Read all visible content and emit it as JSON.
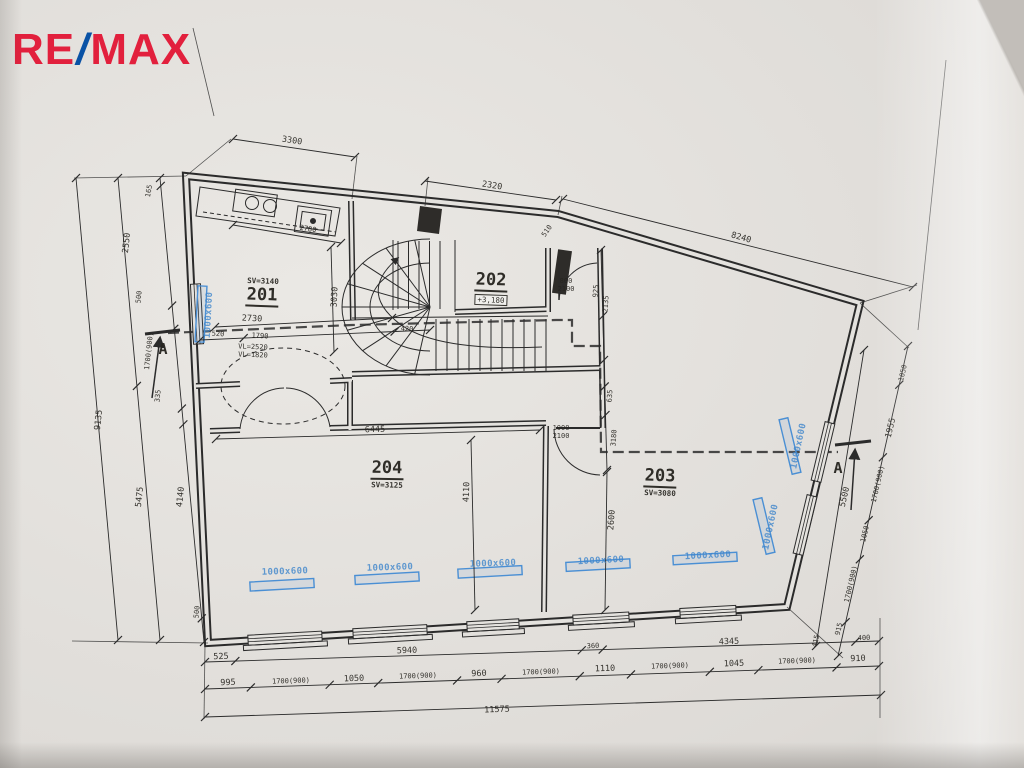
{
  "logo": {
    "re": "RE",
    "slash": "/",
    "max": "MAX"
  },
  "colors": {
    "logo_red": "#e2203d",
    "logo_blue": "#0a52a5",
    "ink": "#2b2b2b",
    "radiator_blue": "#4a8fd4",
    "paper": "#e4e2de"
  },
  "rooms": [
    {
      "number": "201",
      "ceiling": "SV=3140"
    },
    {
      "number": "202",
      "elevation": "+3,180"
    },
    {
      "number": "203",
      "ceiling": "SV=3080"
    },
    {
      "number": "204",
      "ceiling": "SV=3125"
    }
  ],
  "labels": [
    {
      "t": "3300",
      "x": 292,
      "y": 141,
      "r": 8
    },
    {
      "t": "2320",
      "x": 492,
      "y": 186,
      "r": 9
    },
    {
      "t": "8240",
      "x": 741,
      "y": 238,
      "r": 16
    },
    {
      "t": "165",
      "x": 149,
      "y": 191,
      "r": -80,
      "c": "t"
    },
    {
      "t": "2550",
      "x": 127,
      "y": 243,
      "r": -84
    },
    {
      "t": "500",
      "x": 139,
      "y": 297,
      "r": -84,
      "c": "t"
    },
    {
      "t": "1700(900)",
      "x": 149,
      "y": 351,
      "r": -84,
      "c": "t"
    },
    {
      "t": "335",
      "x": 158,
      "y": 396,
      "r": -84,
      "c": "t"
    },
    {
      "t": "4140",
      "x": 181,
      "y": 497,
      "r": -84
    },
    {
      "t": "5475",
      "x": 140,
      "y": 497,
      "r": -84
    },
    {
      "t": "9135",
      "x": 99,
      "y": 420,
      "r": -84
    },
    {
      "t": "500",
      "x": 197,
      "y": 612,
      "r": -84,
      "c": "t"
    },
    {
      "t": "1050",
      "x": 903,
      "y": 373,
      "r": -77,
      "c": "t"
    },
    {
      "t": "1955",
      "x": 891,
      "y": 428,
      "r": -77
    },
    {
      "t": "1700(900)",
      "x": 878,
      "y": 484,
      "r": -77,
      "c": "t"
    },
    {
      "t": "1050",
      "x": 865,
      "y": 534,
      "r": -77,
      "c": "t"
    },
    {
      "t": "1700(900)",
      "x": 851,
      "y": 584,
      "r": -77,
      "c": "t"
    },
    {
      "t": "915",
      "x": 839,
      "y": 629,
      "r": -77,
      "c": "t"
    },
    {
      "t": "415",
      "x": 816,
      "y": 641,
      "r": -77,
      "c": "t"
    },
    {
      "t": "5500",
      "x": 845,
      "y": 497,
      "r": -77
    },
    {
      "t": "525",
      "x": 221,
      "y": 657,
      "r": -2
    },
    {
      "t": "5940",
      "x": 407,
      "y": 651,
      "r": -2
    },
    {
      "t": "360",
      "x": 593,
      "y": 646,
      "r": -2,
      "c": "t"
    },
    {
      "t": "4345",
      "x": 729,
      "y": 642,
      "r": -2
    },
    {
      "t": "400",
      "x": 864,
      "y": 638,
      "r": -2,
      "c": "t"
    },
    {
      "t": "995",
      "x": 228,
      "y": 683,
      "r": -2
    },
    {
      "t": "1700(900)",
      "x": 291,
      "y": 681,
      "r": -2,
      "c": "t"
    },
    {
      "t": "1050",
      "x": 354,
      "y": 679,
      "r": -2
    },
    {
      "t": "1700(900)",
      "x": 418,
      "y": 676,
      "r": -2,
      "c": "t"
    },
    {
      "t": "960",
      "x": 479,
      "y": 674,
      "r": -2
    },
    {
      "t": "1700(900)",
      "x": 541,
      "y": 672,
      "r": -2,
      "c": "t"
    },
    {
      "t": "1110",
      "x": 605,
      "y": 669,
      "r": -2
    },
    {
      "t": "1700(900)",
      "x": 670,
      "y": 666,
      "r": -2,
      "c": "t"
    },
    {
      "t": "1045",
      "x": 734,
      "y": 664,
      "r": -2
    },
    {
      "t": "1700(900)",
      "x": 797,
      "y": 661,
      "r": -2,
      "c": "t"
    },
    {
      "t": "910",
      "x": 858,
      "y": 659,
      "r": -2
    },
    {
      "t": "11575",
      "x": 497,
      "y": 710,
      "r": -2
    },
    {
      "t": "SV=3140",
      "x": 263,
      "y": 281,
      "r": 2,
      "c": "sv"
    },
    {
      "t": "201",
      "x": 262,
      "y": 296,
      "r": 2,
      "c": "room",
      "n": "room-201-number"
    },
    {
      "t": "202",
      "x": 491,
      "y": 281,
      "r": 2,
      "c": "room",
      "n": "room-202-number"
    },
    {
      "t": "+3,180",
      "x": 491,
      "y": 300,
      "r": 2,
      "c": "elev",
      "n": "room-202-elevation"
    },
    {
      "t": "203",
      "x": 660,
      "y": 477,
      "r": 2,
      "c": "room",
      "n": "room-203-number"
    },
    {
      "t": "SV=3080",
      "x": 660,
      "y": 493,
      "r": 2,
      "c": "sv"
    },
    {
      "t": "204",
      "x": 387,
      "y": 469,
      "r": 1,
      "c": "room",
      "n": "room-204-number"
    },
    {
      "t": "SV=3125",
      "x": 387,
      "y": 485,
      "r": 1,
      "c": "sv"
    },
    {
      "t": "2730",
      "x": 252,
      "y": 319,
      "r": 3
    },
    {
      "t": "520",
      "x": 218,
      "y": 334,
      "r": 3,
      "c": "t"
    },
    {
      "t": "1790",
      "x": 260,
      "y": 336,
      "r": 3,
      "c": "t"
    },
    {
      "t": "420",
      "x": 407,
      "y": 329,
      "r": 3,
      "c": "t"
    },
    {
      "t": "VL=2520",
      "x": 253,
      "y": 347,
      "r": 2,
      "c": "t"
    },
    {
      "t": "VL=1820",
      "x": 253,
      "y": 355,
      "r": 2,
      "c": "t"
    },
    {
      "t": "2780",
      "x": 308,
      "y": 229,
      "r": 9,
      "c": "t"
    },
    {
      "t": "6445",
      "x": 375,
      "y": 430,
      "r": -2
    },
    {
      "t": "4110",
      "x": 467,
      "y": 492,
      "r": -88
    },
    {
      "t": "2600",
      "x": 612,
      "y": 520,
      "r": -86
    },
    {
      "t": "3180",
      "x": 614,
      "y": 438,
      "r": -86,
      "c": "t"
    },
    {
      "t": "635",
      "x": 610,
      "y": 396,
      "r": -86,
      "c": "t"
    },
    {
      "t": "925",
      "x": 596,
      "y": 291,
      "r": -86,
      "c": "t"
    },
    {
      "t": "2135",
      "x": 606,
      "y": 304,
      "r": -86,
      "c": "t"
    },
    {
      "t": "800",
      "x": 566,
      "y": 281,
      "r": 0,
      "c": "t"
    },
    {
      "t": "2100",
      "x": 566,
      "y": 289,
      "r": 0,
      "c": "t"
    },
    {
      "t": "1000",
      "x": 561,
      "y": 428,
      "r": 0,
      "c": "t"
    },
    {
      "t": "2100",
      "x": 561,
      "y": 436,
      "r": 0,
      "c": "t"
    },
    {
      "t": "3030",
      "x": 335,
      "y": 297,
      "r": -87
    },
    {
      "t": "510",
      "x": 547,
      "y": 231,
      "r": -55,
      "c": "t"
    },
    {
      "t": "1000x600",
      "x": 285,
      "y": 572,
      "r": -2,
      "c": "blue",
      "n": "radiator-label"
    },
    {
      "t": "1000x600",
      "x": 390,
      "y": 568,
      "r": -2,
      "c": "blue",
      "n": "radiator-label"
    },
    {
      "t": "1000x600",
      "x": 493,
      "y": 564,
      "r": -2,
      "c": "blue",
      "n": "radiator-label"
    },
    {
      "t": "1000x600",
      "x": 601,
      "y": 561,
      "r": -3,
      "c": "blue",
      "n": "radiator-label"
    },
    {
      "t": "1000x600",
      "x": 708,
      "y": 556,
      "r": -3,
      "c": "blue",
      "n": "radiator-label"
    },
    {
      "t": "1000x600",
      "x": 209,
      "y": 315,
      "r": -87,
      "c": "blue",
      "n": "radiator-label"
    },
    {
      "t": "1000x600",
      "x": 799,
      "y": 446,
      "r": -78,
      "c": "blue",
      "n": "radiator-label"
    },
    {
      "t": "1000x600",
      "x": 771,
      "y": 527,
      "r": -78,
      "c": "blue",
      "n": "radiator-label"
    },
    {
      "t": "A",
      "x": 163,
      "y": 349,
      "r": 0,
      "c": "sect",
      "n": "section-marker-a-left"
    },
    {
      "t": "A",
      "x": 838,
      "y": 468,
      "r": 0,
      "c": "sect",
      "n": "section-marker-a-right"
    }
  ]
}
